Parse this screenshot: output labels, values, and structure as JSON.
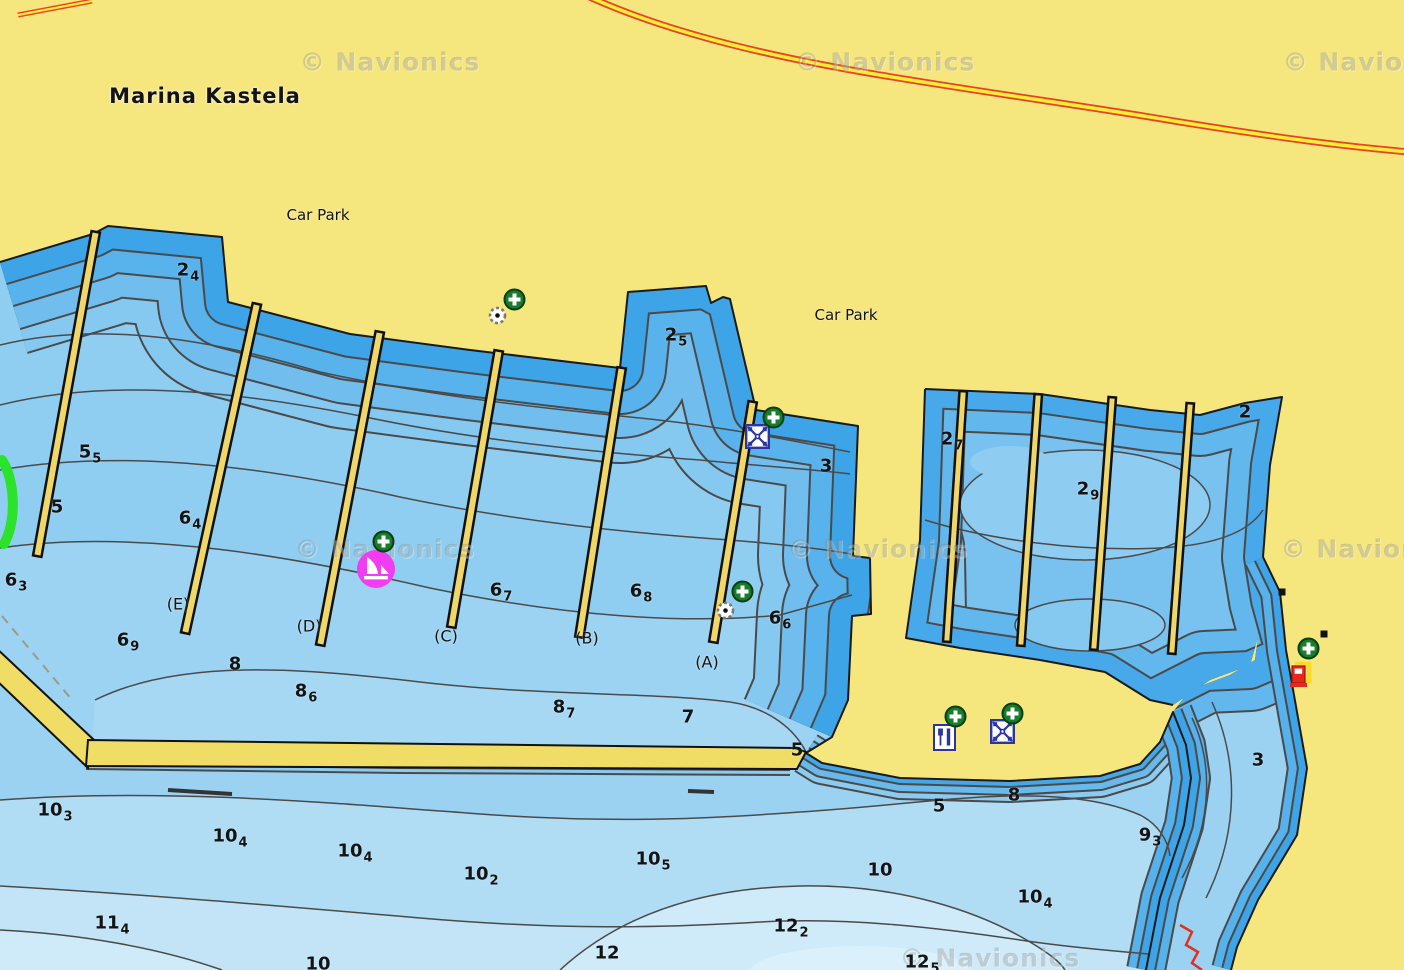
{
  "map": {
    "title": "Marina Kastela",
    "place_labels": [
      {
        "text": "Car Park",
        "x": 318,
        "y": 215
      },
      {
        "text": "Car Park",
        "x": 846,
        "y": 315
      }
    ],
    "watermark_text": "© Navionics",
    "watermark_positions": [
      [
        390,
        62
      ],
      [
        885,
        62
      ],
      [
        1373,
        62
      ],
      [
        385,
        549
      ],
      [
        878,
        549
      ],
      [
        1371,
        549
      ],
      [
        990,
        958
      ]
    ],
    "pier_labels": [
      {
        "text": "(E)",
        "x": 178,
        "y": 604
      },
      {
        "text": "(D)",
        "x": 309,
        "y": 626
      },
      {
        "text": "(C)",
        "x": 446,
        "y": 636
      },
      {
        "text": "(B)",
        "x": 587,
        "y": 638
      },
      {
        "text": "(A)",
        "x": 707,
        "y": 662
      }
    ],
    "soundings": [
      {
        "v": "2",
        "s": "4",
        "x": 188,
        "y": 270
      },
      {
        "v": "2",
        "s": "5",
        "x": 676,
        "y": 335
      },
      {
        "v": "5",
        "s": "5",
        "x": 90,
        "y": 452
      },
      {
        "v": "5",
        "s": "",
        "x": 57,
        "y": 507
      },
      {
        "v": "6",
        "s": "4",
        "x": 190,
        "y": 518
      },
      {
        "v": "6",
        "s": "3",
        "x": 16,
        "y": 580
      },
      {
        "v": "6",
        "s": "5",
        "x": 370,
        "y": 567
      },
      {
        "v": "6",
        "s": "7",
        "x": 501,
        "y": 590
      },
      {
        "v": "6",
        "s": "8",
        "x": 641,
        "y": 591
      },
      {
        "v": "6",
        "s": "6",
        "x": 780,
        "y": 618
      },
      {
        "v": "6",
        "s": "9",
        "x": 128,
        "y": 640
      },
      {
        "v": "8",
        "s": "",
        "x": 235,
        "y": 664
      },
      {
        "v": "8",
        "s": "6",
        "x": 306,
        "y": 691
      },
      {
        "v": "8",
        "s": "7",
        "x": 564,
        "y": 707
      },
      {
        "v": "7",
        "s": "",
        "x": 688,
        "y": 717
      },
      {
        "v": "3",
        "s": "",
        "x": 826,
        "y": 466
      },
      {
        "v": "2",
        "s": "7",
        "x": 952,
        "y": 439
      },
      {
        "v": "2",
        "s": "9",
        "x": 1088,
        "y": 489
      },
      {
        "v": "2",
        "s": "",
        "x": 1245,
        "y": 412
      },
      {
        "v": "5",
        "s": "",
        "x": 797,
        "y": 750
      },
      {
        "v": "5",
        "s": "",
        "x": 939,
        "y": 806
      },
      {
        "v": "8",
        "s": "",
        "x": 1014,
        "y": 795
      },
      {
        "v": "3",
        "s": "",
        "x": 1258,
        "y": 760
      },
      {
        "v": "9",
        "s": "3",
        "x": 1150,
        "y": 835
      },
      {
        "v": "10",
        "s": "3",
        "x": 55,
        "y": 810
      },
      {
        "v": "10",
        "s": "4",
        "x": 230,
        "y": 836
      },
      {
        "v": "10",
        "s": "4",
        "x": 355,
        "y": 851
      },
      {
        "v": "10",
        "s": "2",
        "x": 481,
        "y": 874
      },
      {
        "v": "10",
        "s": "5",
        "x": 653,
        "y": 859
      },
      {
        "v": "10",
        "s": "",
        "x": 880,
        "y": 870
      },
      {
        "v": "10",
        "s": "4",
        "x": 1035,
        "y": 897
      },
      {
        "v": "11",
        "s": "4",
        "x": 112,
        "y": 923
      },
      {
        "v": "12",
        "s": "2",
        "x": 791,
        "y": 926
      },
      {
        "v": "12",
        "s": "",
        "x": 607,
        "y": 953
      },
      {
        "v": "12",
        "s": "5",
        "x": 922,
        "y": 962
      },
      {
        "v": "10",
        "s": "",
        "x": 318,
        "y": 964
      }
    ],
    "icons": [
      {
        "t": "light",
        "n": "minor-light-icon",
        "x": 488,
        "y": 306
      },
      {
        "t": "plus",
        "n": "poi-plus-badge",
        "x": 503,
        "y": 288
      },
      {
        "t": "marina",
        "n": "marina-icon",
        "x": 355,
        "y": 548
      },
      {
        "t": "plus",
        "n": "poi-plus-badge",
        "x": 372,
        "y": 530
      },
      {
        "t": "grid",
        "n": "dock-services-icon",
        "x": 745,
        "y": 424
      },
      {
        "t": "plus",
        "n": "poi-plus-badge",
        "x": 762,
        "y": 406
      },
      {
        "t": "light",
        "n": "minor-light-icon",
        "x": 716,
        "y": 601
      },
      {
        "t": "plus",
        "n": "poi-plus-badge",
        "x": 731,
        "y": 580
      },
      {
        "t": "restaurant",
        "n": "restaurant-icon",
        "x": 933,
        "y": 724
      },
      {
        "t": "plus",
        "n": "poi-plus-badge",
        "x": 944,
        "y": 705
      },
      {
        "t": "grid",
        "n": "dock-services-icon",
        "x": 990,
        "y": 719
      },
      {
        "t": "plus",
        "n": "poi-plus-badge",
        "x": 1001,
        "y": 702
      },
      {
        "t": "fuel",
        "n": "fuel-station-icon",
        "x": 1286,
        "y": 658
      },
      {
        "t": "plus",
        "n": "poi-plus-badge",
        "x": 1297,
        "y": 637
      },
      {
        "t": "square",
        "n": "obstruction-icon",
        "x": 1278,
        "y": 588
      },
      {
        "t": "square",
        "n": "obstruction-icon",
        "x": 1320,
        "y": 630
      }
    ],
    "colors": {
      "land": "#f5e67e",
      "pier": "#f0d76a",
      "water_shallowest": "#3da4e7",
      "water_marina": "#90cef1",
      "water_deep": "#c2e4f6",
      "road_casing": "#e8402a",
      "road_fill": "#f8ee33",
      "marina_poi": "#f23cf2",
      "poi_badge": "#177d2b",
      "fuel_red": "#e8281e",
      "cable_red": "#e03020",
      "beacon_green": "#2be32b"
    }
  }
}
